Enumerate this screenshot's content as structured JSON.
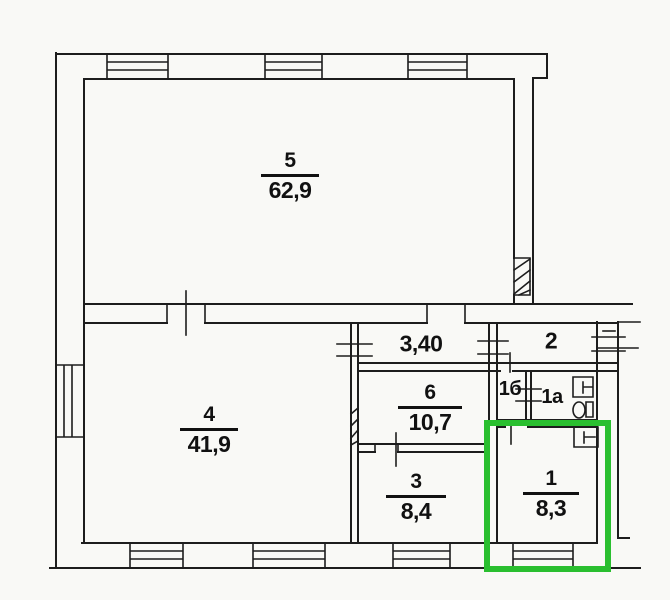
{
  "document": {
    "kind": "scanned apartment floor plan with one room highlighted"
  },
  "colors": {
    "background": "#f9f9f6",
    "line": "#1d1d1d",
    "text": "#111111",
    "highlight": "#2abf2f"
  },
  "rooms": {
    "room5": {
      "number": "5",
      "area": "62,9"
    },
    "room4": {
      "number": "4",
      "area": "41,9"
    },
    "room6": {
      "number": "6",
      "area": "10,7"
    },
    "room3": {
      "number": "3",
      "area": "8,4"
    },
    "room2": {
      "number": "2"
    },
    "room1b": {
      "number": "1б"
    },
    "room1a": {
      "number": "1a"
    },
    "room1": {
      "number": "1",
      "area": "8,3",
      "highlighted": true
    },
    "hallway": {
      "label": "3,40"
    }
  },
  "annotations": {
    "highlighted_room": "1"
  }
}
